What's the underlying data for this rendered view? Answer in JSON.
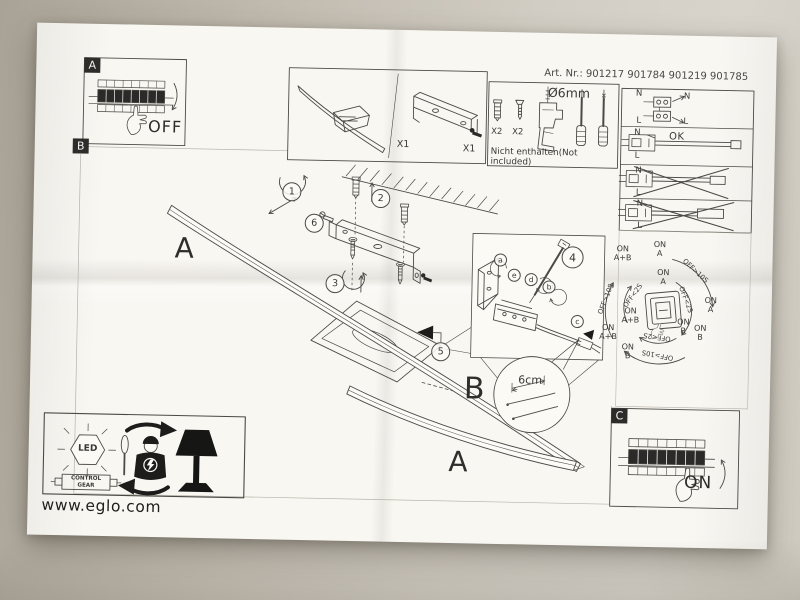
{
  "header": {
    "art_nr": "Art. Nr.: 901217 901784 901219 901785"
  },
  "sections": {
    "a": {
      "label": "A",
      "state": "OFF"
    },
    "b": {
      "label": "B"
    },
    "c": {
      "label": "C",
      "state": "ON"
    }
  },
  "parts": {
    "lamp_qty": "X1",
    "bracket_qty": "X1"
  },
  "not_included": {
    "drill_diameter": "Ø6mm",
    "anchor_qty": "X2",
    "screw_qty": "X2",
    "caption": "Nicht enthalten(Not included)"
  },
  "wiring": {
    "neutral": "N",
    "live": "L",
    "ok": "OK"
  },
  "steps": {
    "1": "1",
    "2": "2",
    "3": "3",
    "4": "4",
    "5": "5",
    "6": "6"
  },
  "detail_letters": {
    "a": "a",
    "b": "b",
    "c": "c",
    "d": "d",
    "e": "e"
  },
  "measurement": {
    "strip_length": "6cm"
  },
  "mode_diagram": {
    "on_a": "ON\nA",
    "on_b": "ON\nB",
    "on_ab": "ON\nA+B",
    "long_press": "OFF>10S",
    "short_press": "OFF<2S"
  },
  "lamp_labels": {
    "arm_a": "A",
    "cover_b": "B"
  },
  "footer": {
    "led": "LED",
    "control_gear": "CONTROL\nGEAR",
    "website": "www.eglo.com"
  }
}
